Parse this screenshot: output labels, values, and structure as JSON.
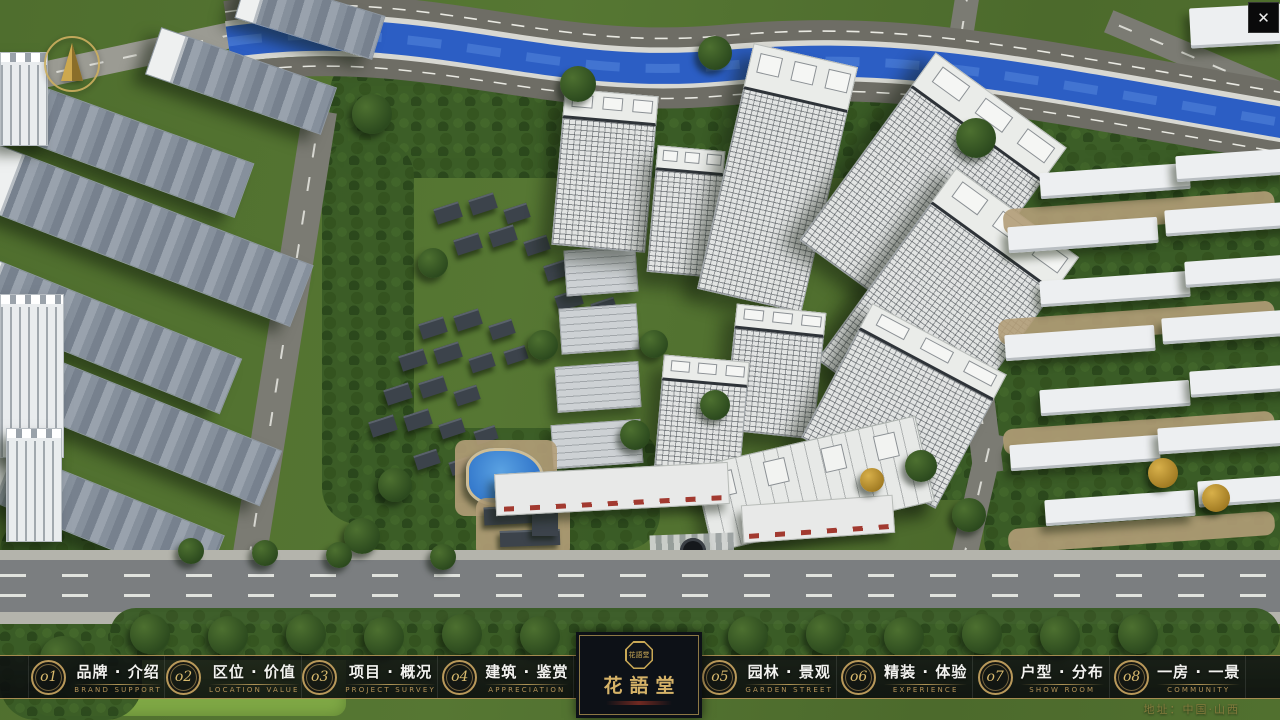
{
  "window": {
    "close_glyph": "✕"
  },
  "menu": {
    "items": [
      {
        "num": "o1",
        "zh": "品牌 · 介绍",
        "en": "BRAND SUPPORT"
      },
      {
        "num": "o2",
        "zh": "区位 · 价值",
        "en": "LOCATION VALUE"
      },
      {
        "num": "o3",
        "zh": "项目 · 概况",
        "en": "PROJECT SURVEY"
      },
      {
        "num": "o4",
        "zh": "建筑 · 鉴赏",
        "en": "APPRECIATION"
      },
      {
        "num": "o5",
        "zh": "园林 · 景观",
        "en": "GARDEN STREET"
      },
      {
        "num": "o6",
        "zh": "精装 · 体验",
        "en": "EXPERIENCE"
      },
      {
        "num": "o7",
        "zh": "户型 · 分布",
        "en": "SHOW ROOM"
      },
      {
        "num": "o8",
        "zh": "一房 · 一景",
        "en": "COMMUNITY"
      }
    ]
  },
  "logo": {
    "title": "花語堂",
    "seal_text": "花語堂"
  },
  "footer": {
    "address": "地址：中国·山西"
  },
  "icons": {
    "compass": "north-arrow-compass",
    "close": "close-x"
  },
  "colors": {
    "gold": "#bfa05c",
    "bar_bg": "rgba(10,12,14,0.84)",
    "river": "#2c5ec4",
    "map_green": "#4f6e2e",
    "building_white": "#e2e4e3"
  }
}
